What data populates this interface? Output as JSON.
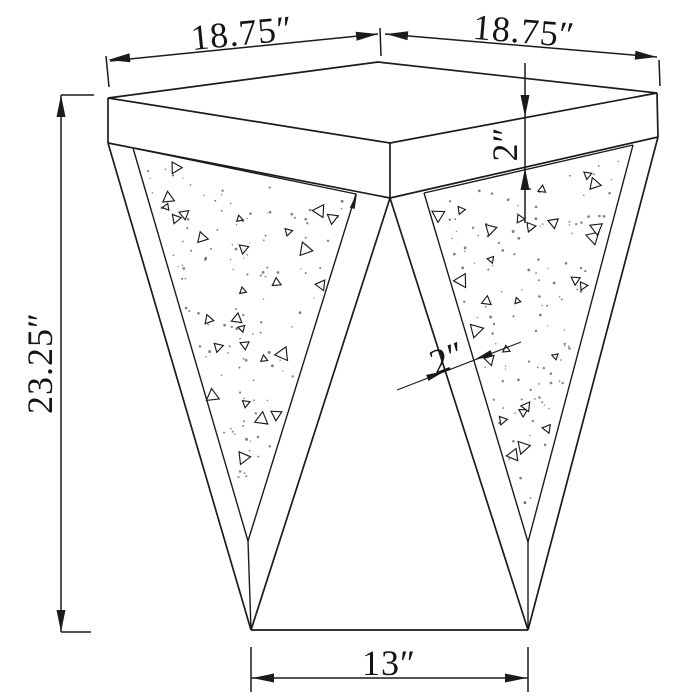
{
  "labels": {
    "top_left_width": "18.75″",
    "top_right_width": "18.75″",
    "overall_height": "23.25″",
    "top_thickness": "2″",
    "frame_thickness": "2″",
    "base_width": "13″"
  }
}
